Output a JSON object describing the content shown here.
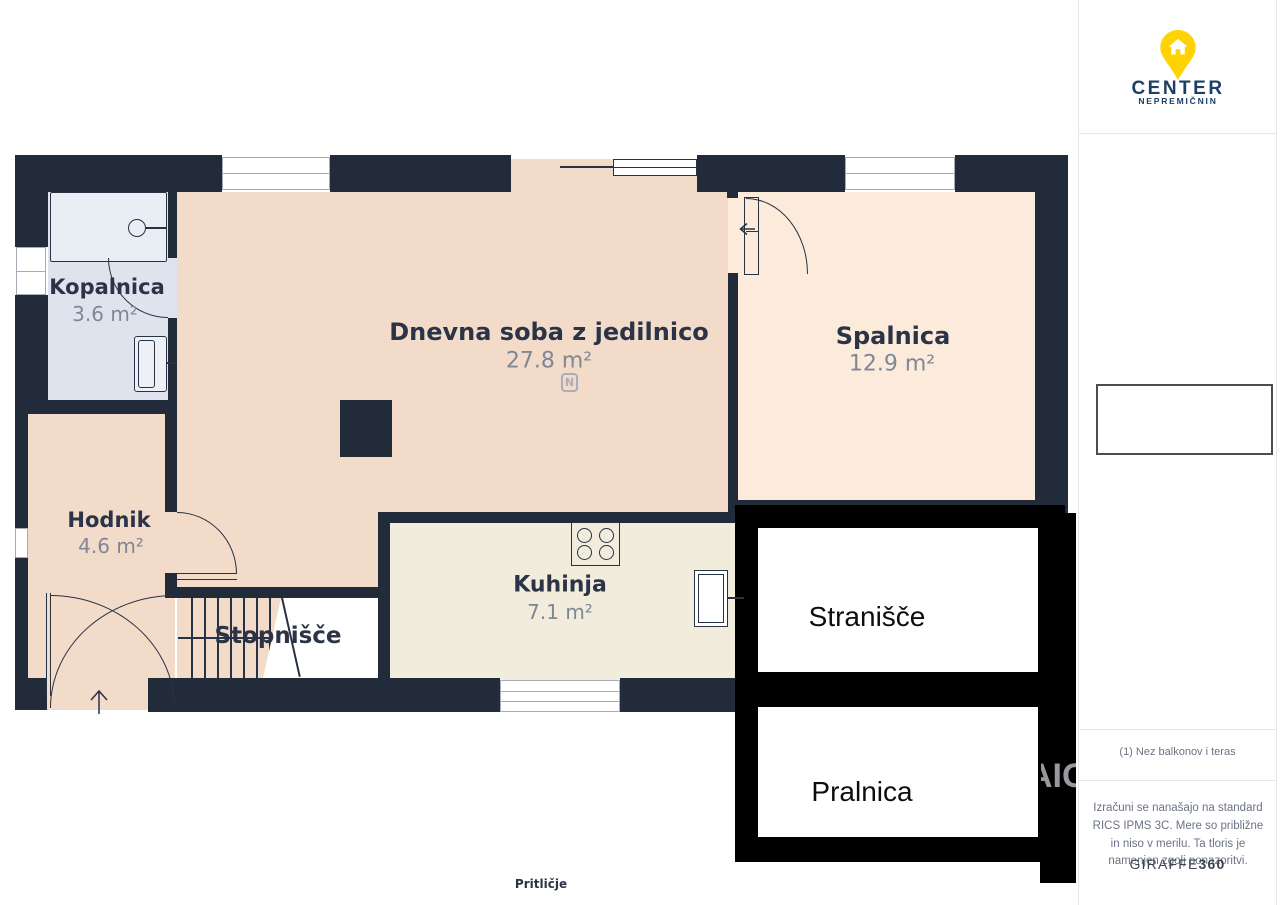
{
  "colors": {
    "wall": "#212b3a",
    "line": "#273244",
    "living": "#f3dbca",
    "bedroom": "#fcebdb",
    "kitchen": "#f1ecdc",
    "bath": "#dfe3ee",
    "tub": "#e9edf4",
    "overlay_black": "#000000",
    "label_navy": "#2b3447",
    "label_gray": "#7f8795",
    "sidebar_text": "#6b7384",
    "border_light": "#e5e7ea",
    "brand_yellow": "#ffd203",
    "brand_navy": "#1c3f66"
  },
  "branding": {
    "logo_title": "CENTER",
    "logo_subtitle": "NEPREMIČNIN"
  },
  "sidebar": {
    "note": "(1) Nez balkonov i teras",
    "disclaimer": "Izračuni se nanašajo na standard RICS IPMS 3C. Mere so približne in niso v merilu. Ta tloris je namenjen zgolj ponazoritvi.",
    "brand": "GIRAFFE",
    "brand_bold": "360"
  },
  "floorplan": {
    "floor_label": "Pritličje",
    "compass": "N",
    "watermark_fragment": "AIG",
    "rooms": [
      {
        "id": "kopalnica",
        "name": "Kopalnica",
        "area": "3.6 m²"
      },
      {
        "id": "dnevna-soba",
        "name": "Dnevna soba z jedilnico",
        "area": "27.8 m²"
      },
      {
        "id": "spalnica",
        "name": "Spalnica",
        "area": "12.9 m²"
      },
      {
        "id": "hodnik",
        "name": "Hodnik",
        "area": "4.6 m²"
      },
      {
        "id": "kuhinja",
        "name": "Kuhinja",
        "area": "7.1 m²"
      },
      {
        "id": "stopnisce",
        "name": "Stopnišče",
        "area": ""
      },
      {
        "id": "stranisce",
        "name": "Stranišče",
        "area": ""
      },
      {
        "id": "pralnica",
        "name": "Pralnica",
        "area": ""
      }
    ]
  }
}
